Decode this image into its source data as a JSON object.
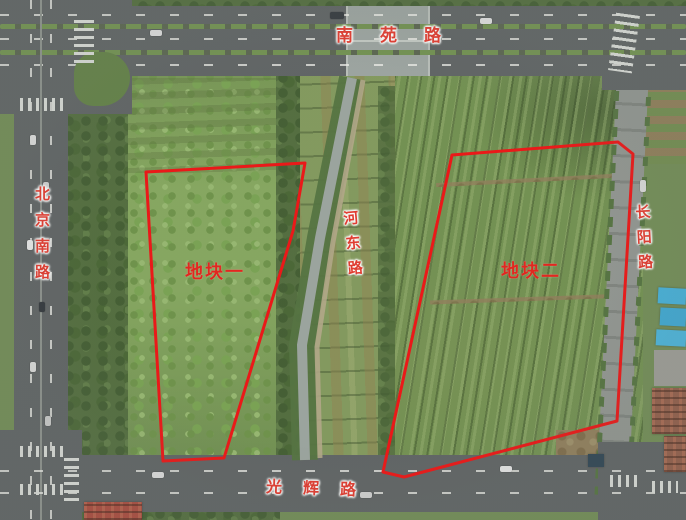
{
  "scene": {
    "type": "aerial-photo-with-parcel-annotations",
    "width_px": 686,
    "height_px": 520
  },
  "roads": {
    "north": {
      "label": "南苑路"
    },
    "west": {
      "label": "北京南路"
    },
    "center": {
      "label": "河东路"
    },
    "east": {
      "label": "长阳路"
    },
    "south": {
      "label": "光辉路"
    }
  },
  "parcels": [
    {
      "label": "地块一",
      "outline_points": "146,172 305,163 293,231 224,458 163,461"
    },
    {
      "label": "地块二",
      "outline_points": "452,155 618,142 633,154 617,421 404,477 383,472"
    }
  ],
  "colors": {
    "annotation_outline": "#ec1010",
    "road_label": "#e2362a",
    "parcel_label": "#e32017",
    "label_halo": "#ffffff",
    "blue_roof": "#41aed8",
    "water": "#99a29c"
  }
}
